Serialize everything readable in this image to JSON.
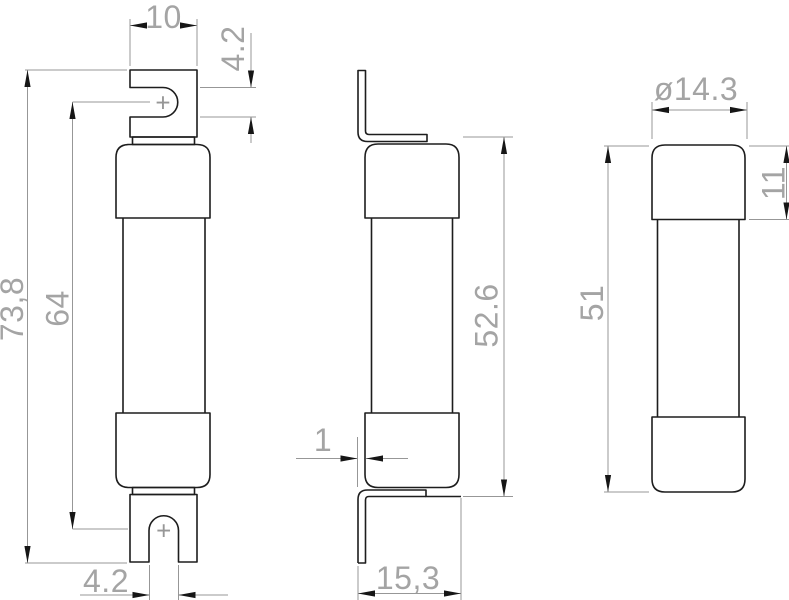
{
  "drawing_type": "technical-orthographic-views",
  "views": {
    "front": {
      "dim_blade_width": "10",
      "dim_slot_width_top": "4.2",
      "dim_overall_length": "73,8",
      "dim_slot_center_distance": "64",
      "dim_slot_width_bottom": "4.2",
      "center_mark_top": "+",
      "center_mark_bottom": "+"
    },
    "side": {
      "dim_tab_thickness": "1",
      "dim_mounting_depth": "15,3",
      "dim_tab_face_distance": "52.6"
    },
    "end": {
      "dim_cap_diameter": "ø14.3",
      "dim_cap_length": "11",
      "dim_body_length": "51"
    }
  },
  "colors": {
    "outline": "#1d1d1d",
    "dimension_line": "#979797",
    "dimension_text": "#a4a4a4",
    "arrowhead": "#161616",
    "background": "#ffffff"
  }
}
